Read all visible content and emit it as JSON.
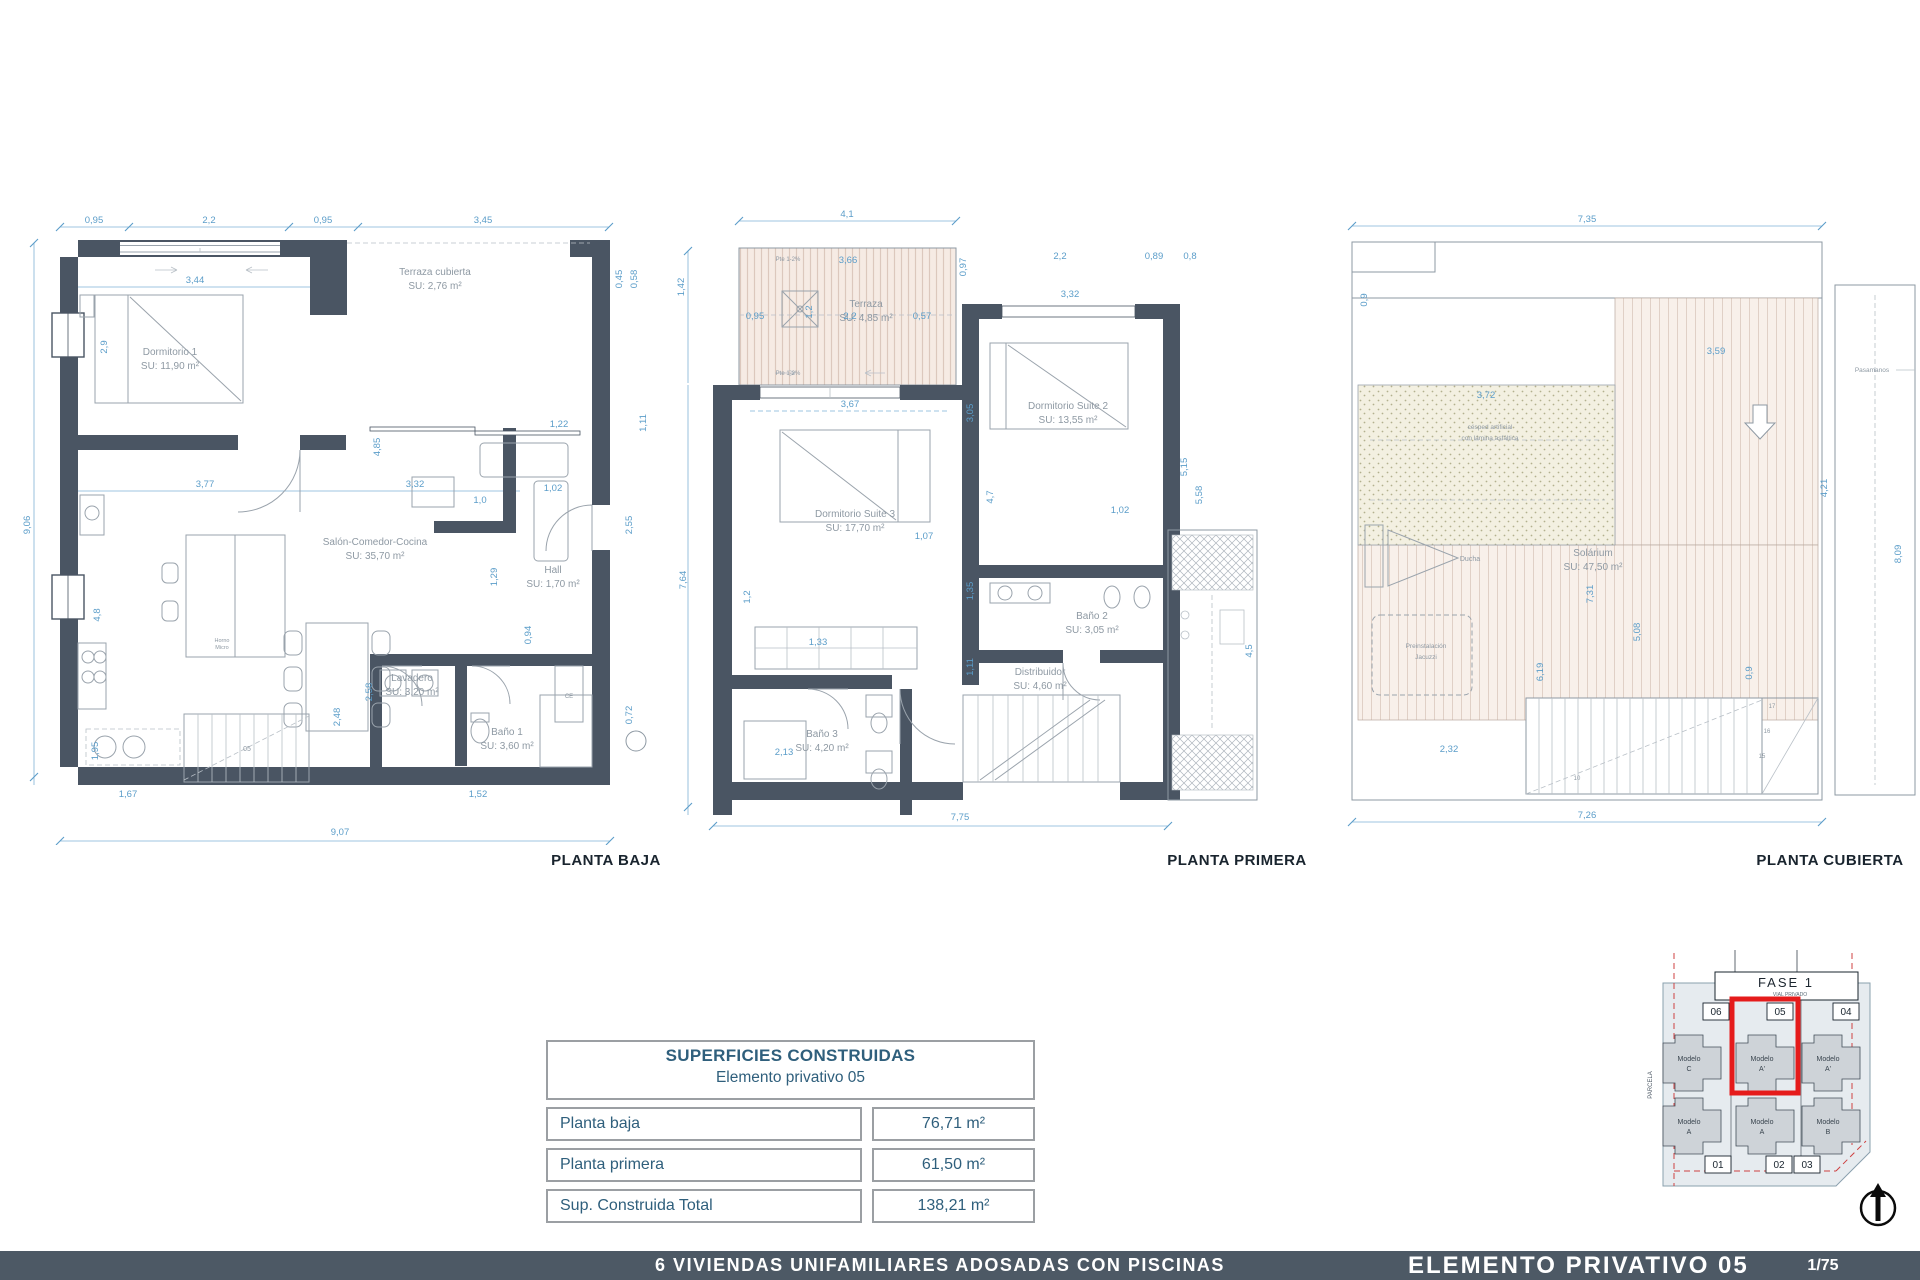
{
  "plans": [
    {
      "title": "PLANTA BAJA",
      "rooms": [
        {
          "name": "Dormitorio 1",
          "area": "SU: 11,90 m²"
        },
        {
          "name": "Terraza cubierta",
          "area": "SU: 2,76 m²"
        },
        {
          "name": "Salón-Comedor-Cocina",
          "area": "SU: 35,70 m²"
        },
        {
          "name": "Hall",
          "area": "SU: 1,70 m²"
        },
        {
          "name": "Lavadero",
          "area": "SU: 3,20 m²"
        },
        {
          "name": "Baño 1",
          "area": "SU: 3,60 m²"
        }
      ],
      "dims": [
        {
          "t": "0,95",
          "x": 84,
          "y": 28
        },
        {
          "t": "2,2",
          "x": 199,
          "y": 28
        },
        {
          "t": "0,95",
          "x": 313,
          "y": 28
        },
        {
          "t": "3,45",
          "x": 473,
          "y": 28
        },
        {
          "t": "3,44",
          "x": 185,
          "y": 88
        },
        {
          "t": "0,45",
          "x": 612,
          "y": 84,
          "r": -90
        },
        {
          "t": "0,58",
          "x": 627,
          "y": 84,
          "r": -90
        },
        {
          "t": "2,9",
          "x": 97,
          "y": 152,
          "r": -90
        },
        {
          "t": "9,06",
          "x": 20,
          "y": 330,
          "r": -90
        },
        {
          "t": "4,8",
          "x": 90,
          "y": 420,
          "r": -90
        },
        {
          "t": "1,95",
          "x": 88,
          "y": 556,
          "r": -90
        },
        {
          "t": "3,77",
          "x": 195,
          "y": 292
        },
        {
          "t": "3,32",
          "x": 405,
          "y": 292
        },
        {
          "t": "1,0",
          "x": 470,
          "y": 308
        },
        {
          "t": "1,02",
          "x": 543,
          "y": 296
        },
        {
          "t": "1,22",
          "x": 549,
          "y": 232
        },
        {
          "t": "4,85",
          "x": 370,
          "y": 252,
          "r": -90
        },
        {
          "t": "1,29",
          "x": 487,
          "y": 382,
          "r": -90
        },
        {
          "t": "0,94",
          "x": 521,
          "y": 440,
          "r": -90
        },
        {
          "t": "2,58",
          "x": 362,
          "y": 497,
          "r": -90
        },
        {
          "t": "2,48",
          "x": 330,
          "y": 522,
          "r": -90
        },
        {
          "t": "2,55",
          "x": 622,
          "y": 330,
          "r": -90
        },
        {
          "t": "0,72",
          "x": 622,
          "y": 520,
          "r": -90
        },
        {
          "t": "1,11",
          "x": 636,
          "y": 228,
          "r": -90
        },
        {
          "t": "1,67",
          "x": 118,
          "y": 602
        },
        {
          "t": "1,52",
          "x": 468,
          "y": 602
        },
        {
          "t": "9,07",
          "x": 330,
          "y": 640
        }
      ],
      "notes": [
        {
          "t": "05",
          "x": 237,
          "y": 556,
          "s": 7
        },
        {
          "t": "CE",
          "x": 559,
          "y": 503,
          "s": 6
        },
        {
          "t": "Horno",
          "x": 212,
          "y": 447,
          "s": 5.5
        },
        {
          "t": "Micro",
          "x": 212,
          "y": 454,
          "s": 5.5
        }
      ]
    },
    {
      "title": "PLANTA PRIMERA",
      "rooms": [
        {
          "name": "Terraza",
          "area": "SU: 4,85 m²"
        },
        {
          "name": "Dormitorio Suite 3",
          "area": "SU: 17,70 m²"
        },
        {
          "name": "Dormitorio Suite 2",
          "area": "SU: 13,55 m²"
        },
        {
          "name": "Baño 2",
          "area": "SU: 3,05 m²"
        },
        {
          "name": "Distribuidor",
          "area": "SU: 4,60 m²"
        },
        {
          "name": "Baño 3",
          "area": "SU: 4,20 m²"
        }
      ],
      "dims": [
        {
          "t": "4,1",
          "x": 187,
          "y": 22
        },
        {
          "t": "1,42",
          "x": 24,
          "y": 92,
          "r": -90
        },
        {
          "t": "3,66",
          "x": 188,
          "y": 68
        },
        {
          "t": "0,95",
          "x": 95,
          "y": 124
        },
        {
          "t": "1,2",
          "x": 152,
          "y": 117,
          "r": -90
        },
        {
          "t": "2,2",
          "x": 190,
          "y": 124
        },
        {
          "t": "0,57",
          "x": 262,
          "y": 124
        },
        {
          "t": "0,97",
          "x": 306,
          "y": 72,
          "r": -90
        },
        {
          "t": "2,2",
          "x": 400,
          "y": 64
        },
        {
          "t": "0,89",
          "x": 494,
          "y": 64
        },
        {
          "t": "0,8",
          "x": 530,
          "y": 64
        },
        {
          "t": "3,32",
          "x": 410,
          "y": 102
        },
        {
          "t": "3,67",
          "x": 190,
          "y": 212
        },
        {
          "t": "3,05",
          "x": 313,
          "y": 218,
          "r": -90
        },
        {
          "t": "5,15",
          "x": 527,
          "y": 272,
          "r": -90
        },
        {
          "t": "5,58",
          "x": 542,
          "y": 300,
          "r": -90
        },
        {
          "t": "7,64",
          "x": 26,
          "y": 385,
          "r": -90
        },
        {
          "t": "1,2",
          "x": 90,
          "y": 402,
          "r": -90
        },
        {
          "t": "4,7",
          "x": 333,
          "y": 302,
          "r": -90
        },
        {
          "t": "1,07",
          "x": 264,
          "y": 344
        },
        {
          "t": "1,02",
          "x": 460,
          "y": 318
        },
        {
          "t": "1,33",
          "x": 158,
          "y": 450
        },
        {
          "t": "1,35",
          "x": 313,
          "y": 396,
          "r": -90
        },
        {
          "t": "1,11",
          "x": 313,
          "y": 472,
          "r": -90
        },
        {
          "t": "4,5",
          "x": 592,
          "y": 456,
          "r": -90
        },
        {
          "t": "2,13",
          "x": 124,
          "y": 560
        },
        {
          "t": "7,75",
          "x": 300,
          "y": 625
        }
      ],
      "notes": [
        {
          "t": "Pte 1-2%",
          "x": 128,
          "y": 66,
          "s": 6
        },
        {
          "t": "Pte 1-2%",
          "x": 128,
          "y": 180,
          "s": 6
        }
      ]
    },
    {
      "title": "PLANTA CUBIERTA",
      "rooms": [
        {
          "name": "Solárium",
          "area": "SU: 47,50 m²"
        }
      ],
      "dims": [
        {
          "t": "7,35",
          "x": 247,
          "y": 22
        },
        {
          "t": "0,9",
          "x": 27,
          "y": 100,
          "r": -90
        },
        {
          "t": "3,72",
          "x": 146,
          "y": 198
        },
        {
          "t": "3,59",
          "x": 376,
          "y": 154
        },
        {
          "t": "4,21",
          "x": 487,
          "y": 288,
          "r": -90
        },
        {
          "t": "8,09",
          "x": 561,
          "y": 354,
          "r": -90
        },
        {
          "t": "7,31",
          "x": 253,
          "y": 394,
          "r": -90
        },
        {
          "t": "5,08",
          "x": 300,
          "y": 432,
          "r": -90
        },
        {
          "t": "6,19",
          "x": 203,
          "y": 472,
          "r": -90
        },
        {
          "t": "0,9",
          "x": 412,
          "y": 473,
          "r": -90
        },
        {
          "t": "2,32",
          "x": 109,
          "y": 552
        },
        {
          "t": "7,26",
          "x": 247,
          "y": 618
        }
      ],
      "notes": [
        {
          "t": "Ducha",
          "x": 130,
          "y": 361,
          "s": 7
        },
        {
          "t": "Preinstalación",
          "x": 86,
          "y": 448,
          "s": 6.5
        },
        {
          "t": "Jacuzzi",
          "x": 86,
          "y": 459,
          "s": 6.5
        },
        {
          "t": "césped artificial",
          "x": 150,
          "y": 229,
          "s": 6.5
        },
        {
          "t": "con lámina asfáltica",
          "x": 150,
          "y": 240,
          "s": 6.5
        },
        {
          "t": "Pasamanos",
          "x": 532,
          "y": 172,
          "s": 6.5
        },
        {
          "t": "17",
          "x": 432,
          "y": 508,
          "s": 6
        },
        {
          "t": "16",
          "x": 427,
          "y": 533,
          "s": 6
        },
        {
          "t": "15",
          "x": 422,
          "y": 558,
          "s": 6
        },
        {
          "t": "10",
          "x": 237,
          "y": 580,
          "s": 6
        }
      ]
    }
  ],
  "areas_table": {
    "title": "SUPERFICIES CONSTRUIDAS",
    "subtitle": "Elemento privativo 05",
    "rows": [
      {
        "label": "Planta baja",
        "value": "76,71 m²"
      },
      {
        "label": "Planta primera",
        "value": "61,50 m²"
      },
      {
        "label": "Sup. Construida Total",
        "value": "138,21 m²"
      }
    ]
  },
  "site_key": {
    "phase": "FASE 1",
    "phase_sub": "VIAL PRIVADO",
    "parcela": "PARCELA",
    "plots_top": [
      "06",
      "05",
      "04"
    ],
    "plots_bottom": [
      "01",
      "02",
      "03"
    ],
    "models_top": [
      {
        "l1": "Modelo",
        "l2": "C"
      },
      {
        "l1": "Modelo",
        "l2": "A'"
      },
      {
        "l1": "Modelo",
        "l2": "A'"
      }
    ],
    "models_bottom": [
      {
        "l1": "Modelo",
        "l2": "A"
      },
      {
        "l1": "Modelo",
        "l2": "A"
      },
      {
        "l1": "Modelo",
        "l2": "B"
      }
    ],
    "highlighted_plot": "05"
  },
  "footer": {
    "project": "6 VIVIENDAS UNIFAMILIARES ADOSADAS CON PISCINAS",
    "sheet": "ELEMENTO PRIVATIVO 05",
    "page": "1/75"
  },
  "colors": {
    "wall": "#4a5563",
    "dimension": "#5b9dc9",
    "highlight_red": "#e51b1b",
    "footer_bg": "#4d5965"
  }
}
